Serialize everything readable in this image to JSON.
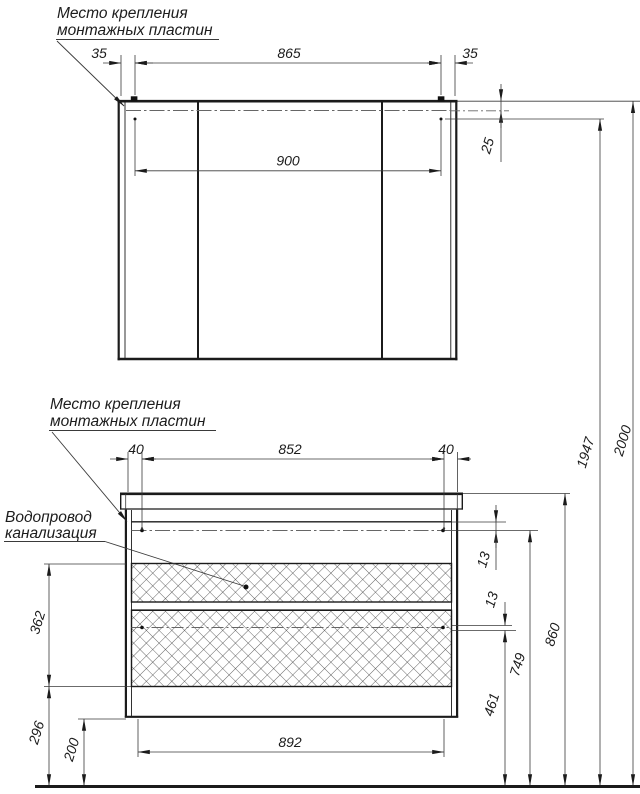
{
  "drawing": {
    "title_context": "furniture installation drawing",
    "annotations": {
      "mirror_mount": {
        "line1": "Место крепления",
        "line2": "монтажных пластин"
      },
      "vanity_mount": {
        "line1": "Место крепления",
        "line2": "монтажных пластин"
      },
      "plumbing": {
        "line1": "Водопровод",
        "line2": "канализация"
      }
    },
    "dims": {
      "mirror_offset_left": "35",
      "mirror_span": "865",
      "mirror_offset_right": "35",
      "mirror_mount_span": "900",
      "mirror_top_gap": "25",
      "vanity_offset_left": "40",
      "vanity_span": "852",
      "vanity_offset_right": "40",
      "gap_top": "13",
      "gap_mid": "13",
      "drawer_zone_height": "362",
      "lower_zone_height": "296",
      "floor_clearance": "200",
      "vanity_bottom_span": "892",
      "h_lower_mount": "461",
      "h_upper_mount": "749",
      "h_countertop": "860",
      "h_mirror_mount": "1947",
      "h_total": "2000"
    },
    "colors": {
      "line": "#1b1b1b",
      "thin": "#3a3a3a",
      "centerline": "#666666",
      "hatch": "#3d3d3d"
    }
  }
}
